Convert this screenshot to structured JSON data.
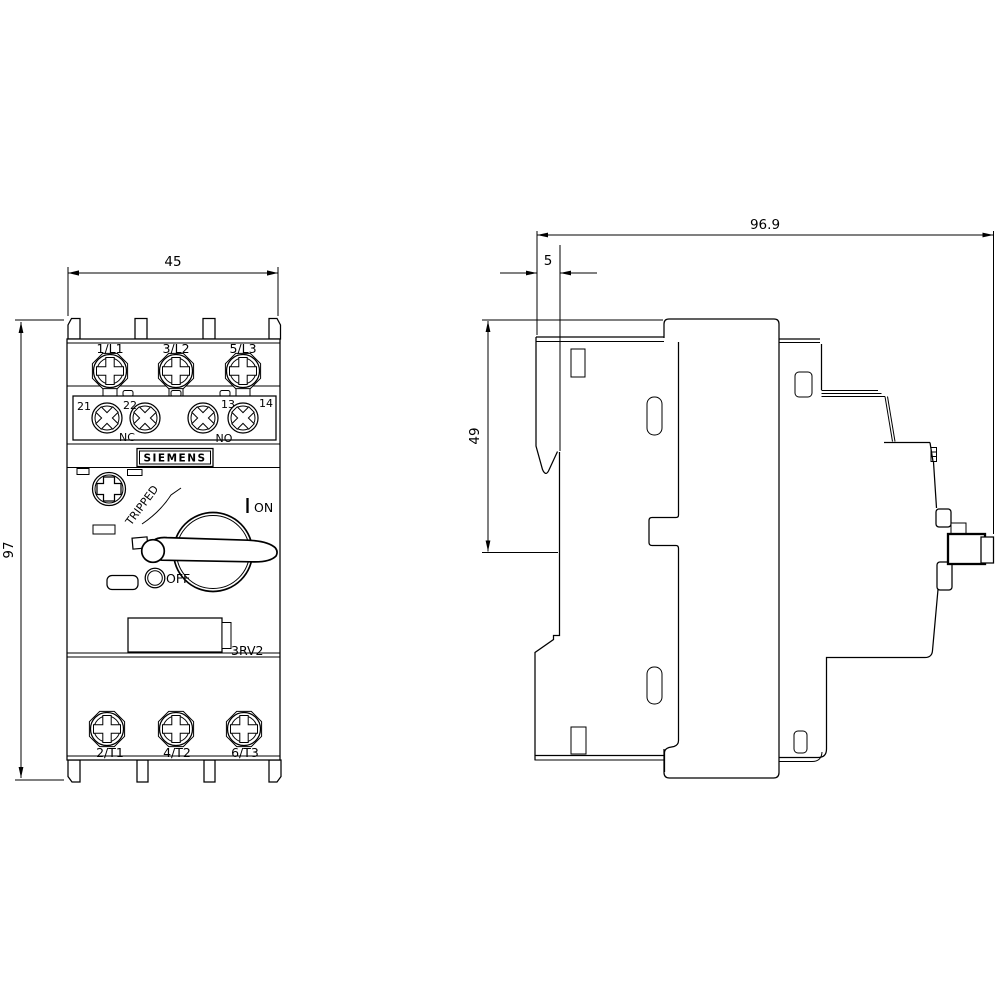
{
  "colors": {
    "line": "#000000",
    "background": "#ffffff"
  },
  "front_view": {
    "top_terminals": [
      "1/L1",
      "3/L2",
      "5/L3"
    ],
    "aux_terminals": [
      "21",
      "22",
      "13",
      "14"
    ],
    "nc_label": "NC",
    "no_label": "NO",
    "brand": "SIEMENS",
    "tripped_label": "TRIPPED",
    "on_label": "ON",
    "off_label": "OFF",
    "model": "3RV2",
    "bottom_terminals": [
      "2/T1",
      "4/T2",
      "6/T3"
    ]
  },
  "dimensions": {
    "width_mm": "45",
    "height_mm": "97",
    "depth_mm": "96.9",
    "flange_mm": "5",
    "upper_height_mm": "49"
  }
}
